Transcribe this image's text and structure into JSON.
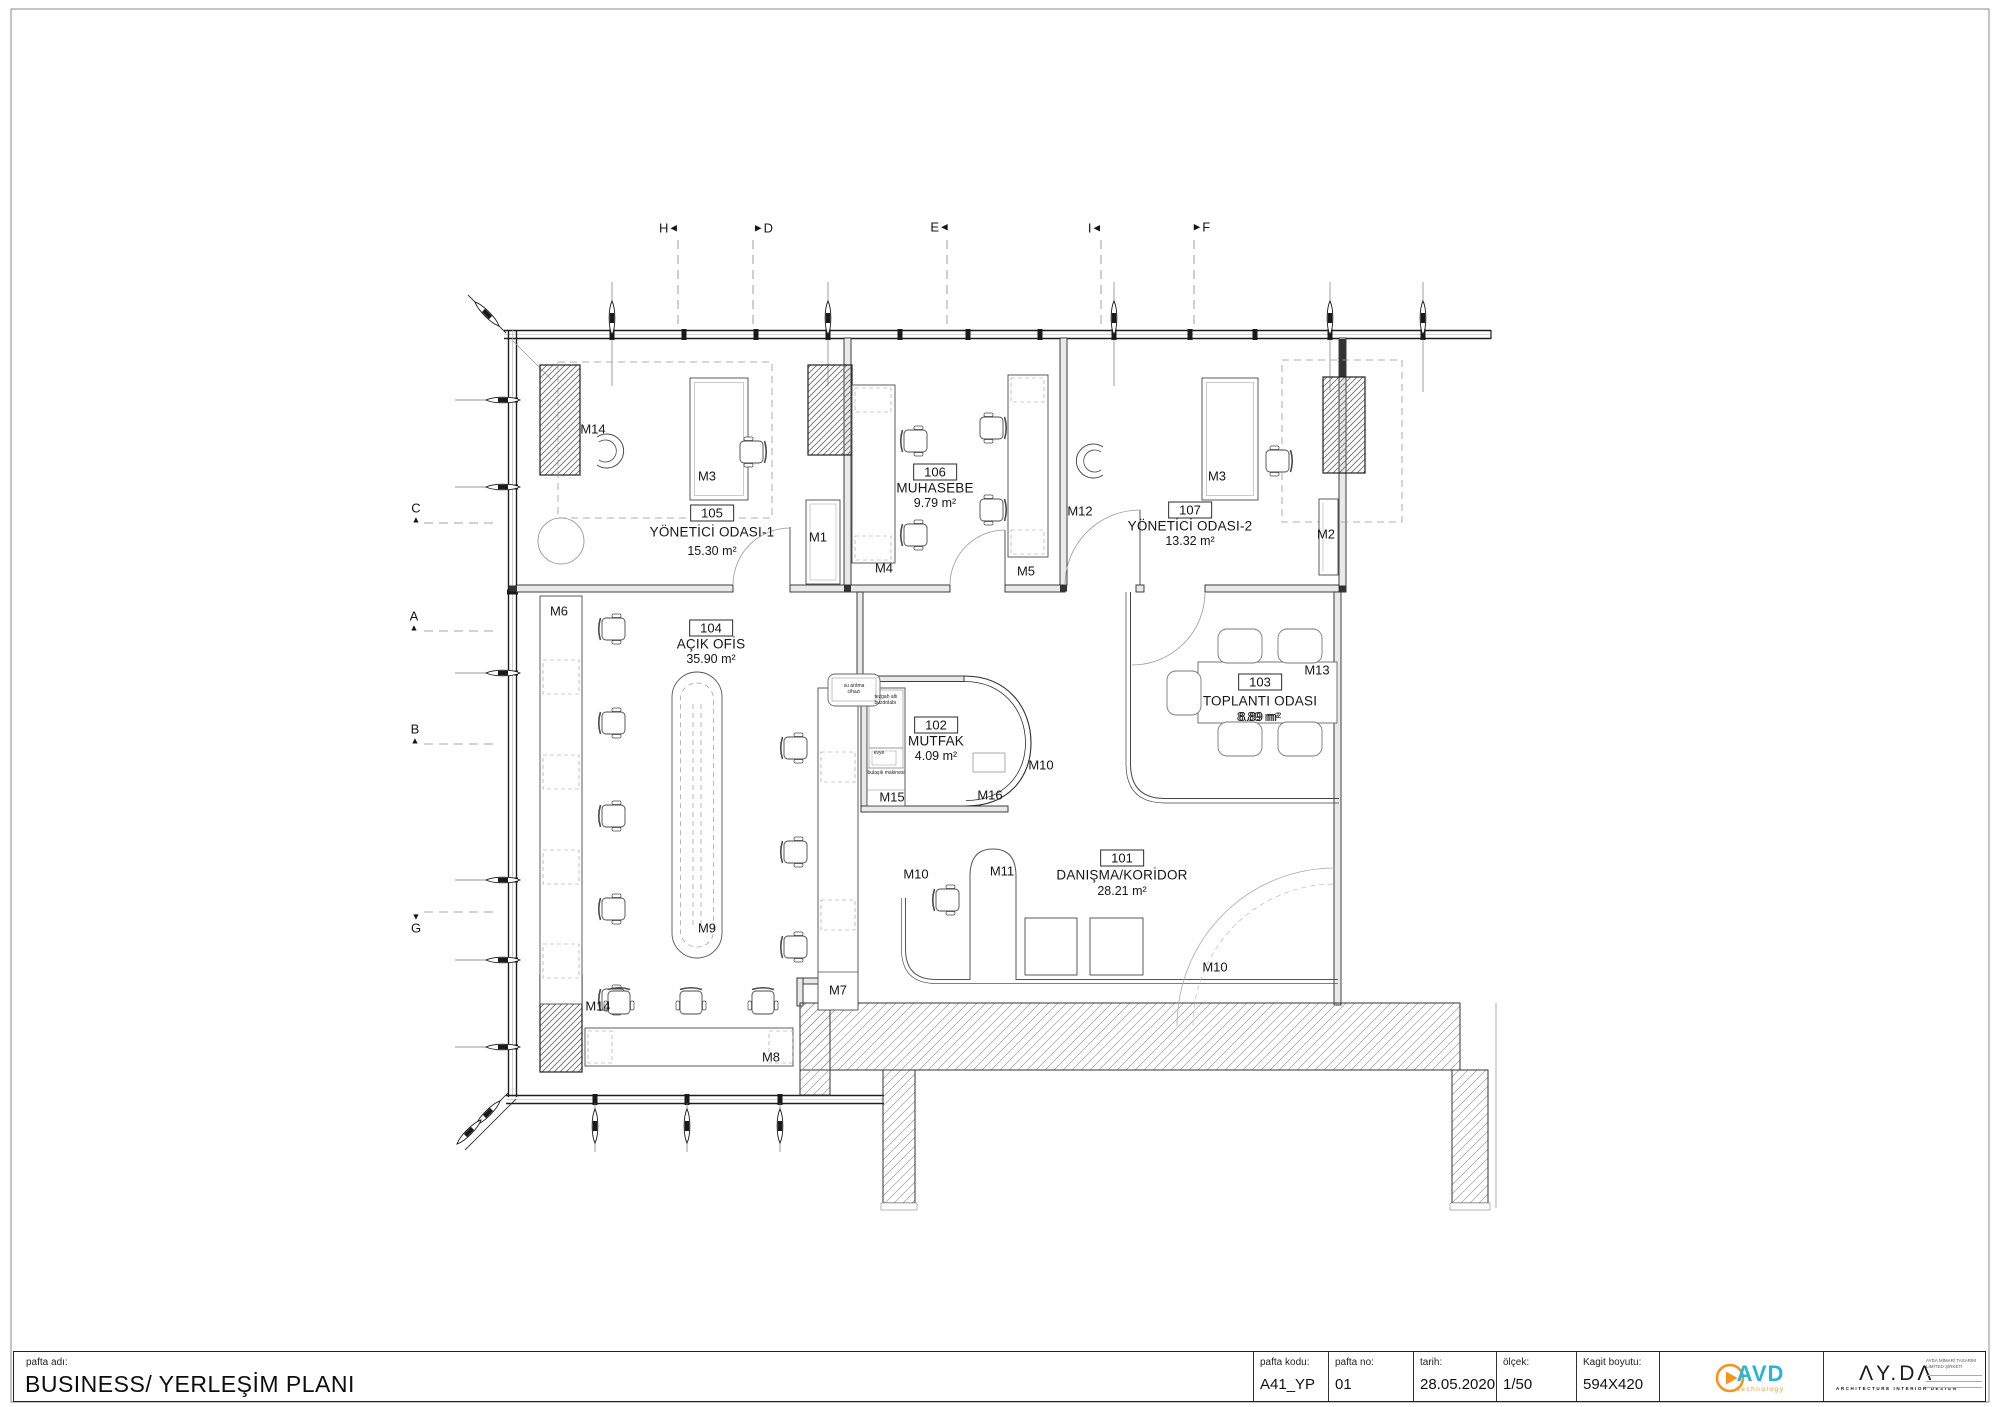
{
  "rooms": {
    "r105": {
      "number": "105",
      "name": "YÖNETİCİ ODASI-1",
      "area": "15.30 m²"
    },
    "r106": {
      "number": "106",
      "name": "MUHASEBE",
      "area": "9.79 m²"
    },
    "r107": {
      "number": "107",
      "name": "YÖNETİCİ ODASI-2",
      "area": "13.32 m²"
    },
    "r104": {
      "number": "104",
      "name": "AÇIK OFİS",
      "area": "35.90 m²"
    },
    "r102": {
      "number": "102",
      "name": "MUTFAK",
      "area": "4.09 m²"
    },
    "r103": {
      "number": "103",
      "name": "TOPLANTI ODASI",
      "area": "8.89 m²"
    },
    "r101": {
      "number": "101",
      "name": "DANIŞMA/KORİDOR",
      "area": "28.21 m²"
    }
  },
  "m_labels": [
    {
      "text": "M14"
    },
    {
      "text": "M3"
    },
    {
      "text": "M1"
    },
    {
      "text": "M4"
    },
    {
      "text": "M5"
    },
    {
      "text": "M12"
    },
    {
      "text": "M3"
    },
    {
      "text": "M2"
    },
    {
      "text": "M6"
    },
    {
      "text": "M13"
    },
    {
      "text": "M15"
    },
    {
      "text": "M16"
    },
    {
      "text": "M10"
    },
    {
      "text": "M10"
    },
    {
      "text": "M11"
    },
    {
      "text": "M9"
    },
    {
      "text": "M14"
    },
    {
      "text": "M7"
    },
    {
      "text": "M8"
    },
    {
      "text": "M10"
    }
  ],
  "grid": {
    "top": [
      {
        "letter": "H",
        "tri": "◀"
      },
      {
        "letter": "D",
        "tri": "▶"
      },
      {
        "letter": "E",
        "tri": "◀"
      },
      {
        "letter": "I",
        "tri": "◀"
      },
      {
        "letter": "F",
        "tri": "▶"
      }
    ],
    "left": [
      {
        "letter": "C",
        "tri": "▲"
      },
      {
        "letter": "A",
        "tri": "▲"
      },
      {
        "letter": "B",
        "tri": "▲"
      },
      {
        "letter": "G",
        "tri": "▼"
      }
    ]
  },
  "kitchen": {
    "su_aritma_1": "su arıtma",
    "su_aritma_2": "cihazı",
    "buzdolabi_1": "tezgah altı",
    "buzdolabi_2": "buzdolabı",
    "evye": "evye",
    "bulasik": "bulaşık makinesi"
  },
  "title_block": {
    "pafta_adi_label": "pafta adı:",
    "sheet_name": "BUSINESS/  YERLEŞİM  PLANI",
    "pafta_kodu_label": "pafta kodu:",
    "pafta_kodu": "A41_YP",
    "pafta_no_label": "pafta no:",
    "pafta_no": "01",
    "tarih_label": "tarih:",
    "tarih": "28.05.2020",
    "olcek_label": "ölçek:",
    "olcek": "1/50",
    "kagit_label": "Kagit boyutu:",
    "kagit": "594X420"
  },
  "logos": {
    "avd": {
      "name": "AVD",
      "sub": "technology",
      "accent": "#f7941e",
      "text_color": "#2ab4d6"
    },
    "ayda": {
      "name": "ΛY.DΛ",
      "sub": "ARCHITECTURE  INTERIOR  DESIGN",
      "stamp_1": "AYDA MİMARİ TASARIM",
      "stamp_2": "LİMİTED ŞİRKETİ"
    }
  }
}
